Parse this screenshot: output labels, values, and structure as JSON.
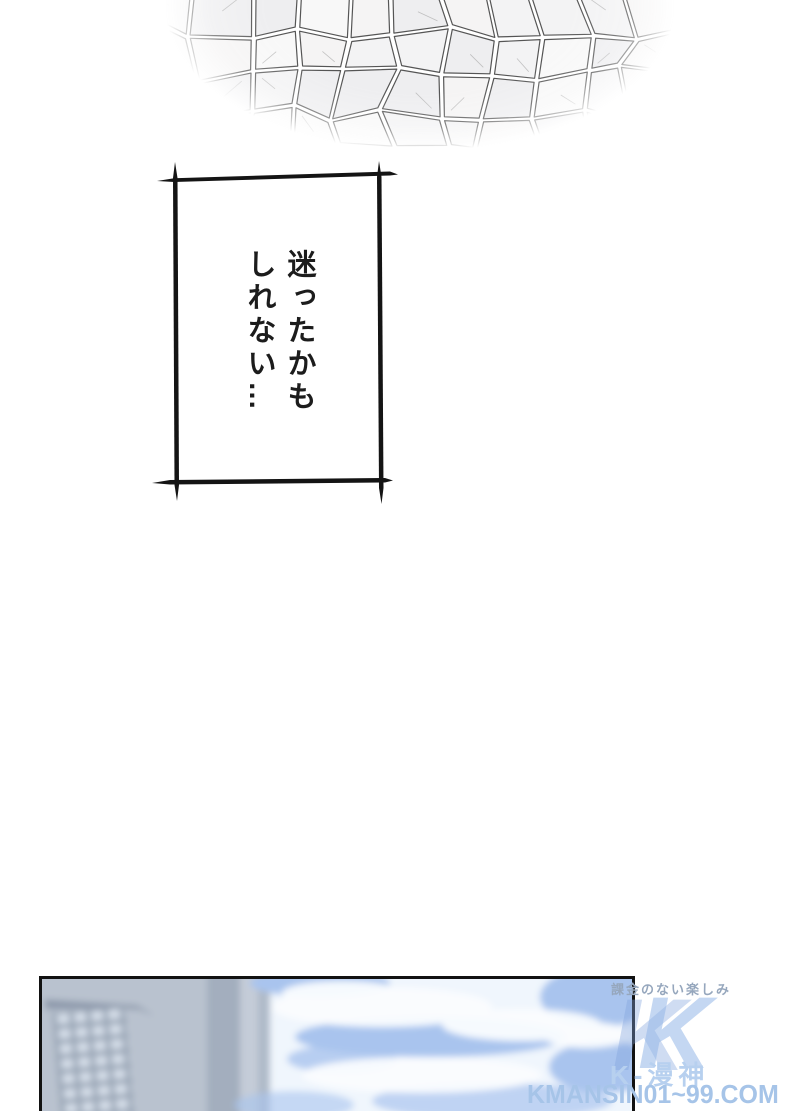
{
  "dialogue": {
    "text": "迷ったかも\nしれない…"
  },
  "watermark": {
    "slogan": "課金のない楽しみ",
    "logo_letter": "K",
    "name": "K-漫神",
    "site": "KMANSIN01~99.COM"
  },
  "colors": {
    "stone_line": "#474747",
    "stone_crease": "#9a9a9a",
    "frame_ink": "#141414",
    "building_gray": "#b9c2cf",
    "building_dark_strip": "#a3aebe",
    "building_light": "#c4ccd8",
    "building_medium_strip": "#aeb9c8",
    "window_light": "#d4dde8",
    "window_gap": "#9aa6b6",
    "ledge_dark": "#8d99ab",
    "sky_base": "#f0f6fd",
    "sky_blue": "#a9c4ee",
    "cloud_white": "#fbfdff"
  }
}
